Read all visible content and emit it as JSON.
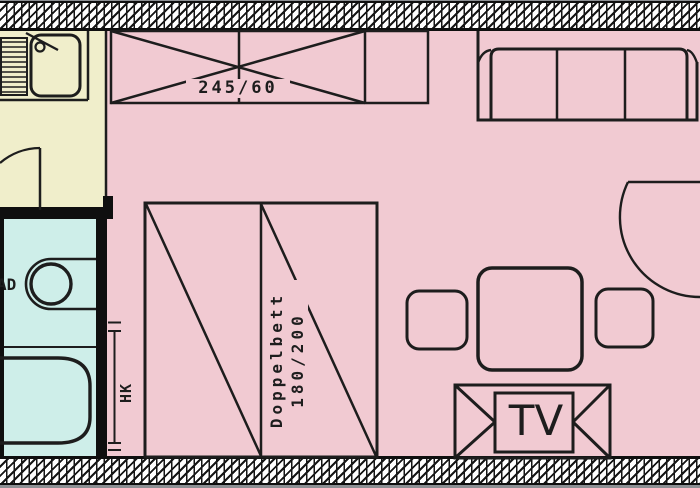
{
  "plan": {
    "kind": "apartment-floor-plan",
    "labels": {
      "wardrobe_dimensions": "245/60",
      "bed_name": "Doppelbett",
      "bed_dimensions": "180/200",
      "radiator": "HK",
      "tv": "TV",
      "bathroom": "AD"
    },
    "rooms": [
      {
        "name": "living-room",
        "color_key": "room_pink"
      },
      {
        "name": "kitchen",
        "color_key": "kitchen_cream"
      },
      {
        "name": "bathroom",
        "color_key": "bath_cyan"
      }
    ],
    "furniture": [
      "wardrobe-245x60",
      "sofa",
      "double-bed-180x200",
      "dining-table",
      "chair-left",
      "chair-right",
      "tv-lowboard",
      "kitchen-counter",
      "kitchen-sink",
      "drainer",
      "toilet",
      "bathtub",
      "radiator-hk",
      "entrance-door",
      "kitchen-door"
    ]
  },
  "colors": {
    "room_pink": "#f1cad2",
    "kitchen_cream": "#f0eecb",
    "bath_cyan": "#ceeee9",
    "line": "#1d1d1d",
    "wall_black": "#0f0f0f",
    "bg_grey": "#8d9094",
    "hatch_bg": "#ffffff"
  }
}
